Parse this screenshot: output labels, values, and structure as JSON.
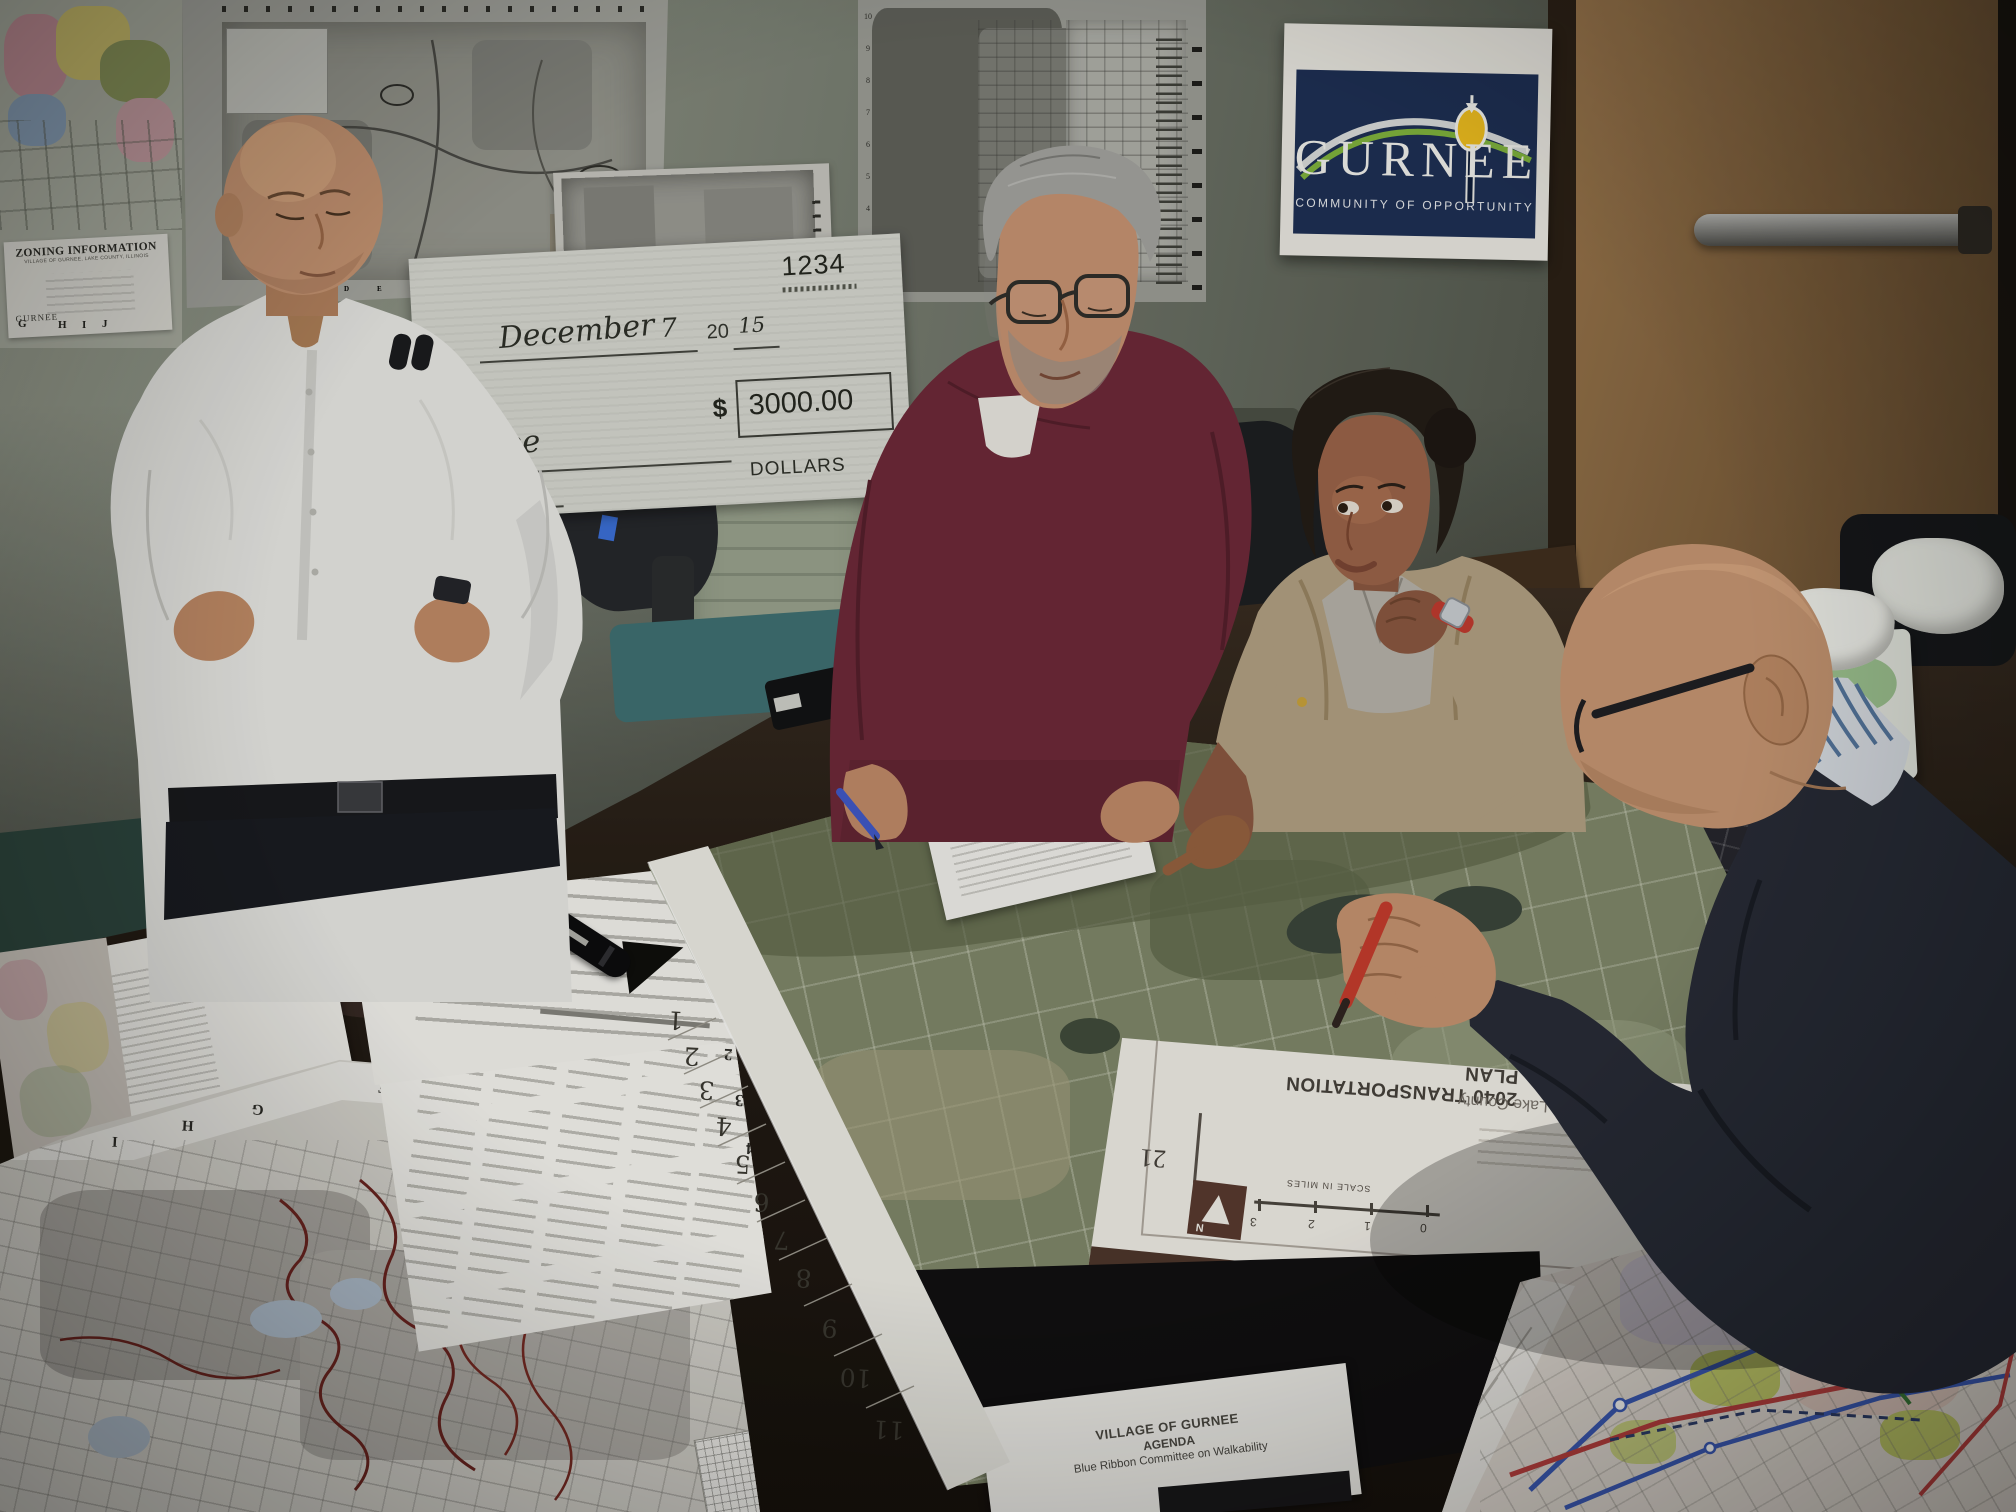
{
  "wall_posters": {
    "zoning_map": {
      "title": "ZONING INFORMATION",
      "subtitle": "VILLAGE OF GURNEE, LAKE COUNTY, ILLINOIS",
      "logo": "GURNEE",
      "grid_letters": [
        "G",
        "H",
        "I",
        "J"
      ]
    },
    "trails_map": {
      "logo": "GURNEE",
      "caption": "Trails Map",
      "grid_letters": [
        "B",
        "C",
        "D",
        "E",
        "F",
        "G",
        "H",
        "I",
        "J",
        "K",
        "L"
      ]
    },
    "sidewalk_poster": {
      "logo": "GURNEE",
      "caption": "Sidewalk Inventory"
    },
    "right_map": {
      "row_numbers": [
        "10",
        "9",
        "8",
        "7",
        "6",
        "5",
        "4",
        "3",
        "2"
      ]
    },
    "gurnee_sign": {
      "title": "GURNEE",
      "tagline": "COMMUNITY OF OPPORTUNITY"
    }
  },
  "check": {
    "number": "1234",
    "date_month": "December",
    "date_day": "7",
    "year_prefix": "20",
    "year": "15",
    "amount_symbol": "$",
    "amount": "3000.00",
    "payee": "Gurnee",
    "cents": "/100",
    "dollars_label": "DOLLARS"
  },
  "table": {
    "aerial_map": {
      "margin_numbers": [
        "1",
        "2",
        "3",
        "4",
        "5",
        "6",
        "7",
        "8",
        "9",
        "10",
        "11"
      ]
    },
    "transportation_sheet": {
      "title": "2040 TRANSPORTATION PLAN",
      "region": "Lake County",
      "page": "21",
      "north": "N",
      "scale_label": "SCALE IN MILES",
      "scale_ticks": [
        "0",
        "1",
        "2",
        "3"
      ]
    },
    "inventory_sheet": {
      "grid_letters": [
        "A",
        "B"
      ],
      "grid_numbers": [
        "1",
        "2",
        "3",
        "4"
      ]
    },
    "street_map": {
      "grid_letters": [
        "E",
        "F",
        "G",
        "H",
        "I"
      ]
    },
    "agenda_paper": {
      "org": "VILLAGE OF GURNEE",
      "title": "AGENDA",
      "subtitle": "Blue Ribbon Committee on Walkability"
    }
  },
  "colors": {
    "sign_navy": "#1c2e54",
    "sign_green": "#7fb33d",
    "lamp_yellow": "#eebd1e",
    "sweater_maroon": "#6d2838",
    "sweater_navy": "#262a36",
    "cardigan_tan": "#b2a083",
    "pen_red": "#c43a2c",
    "pen_blue": "#3f57c8"
  }
}
